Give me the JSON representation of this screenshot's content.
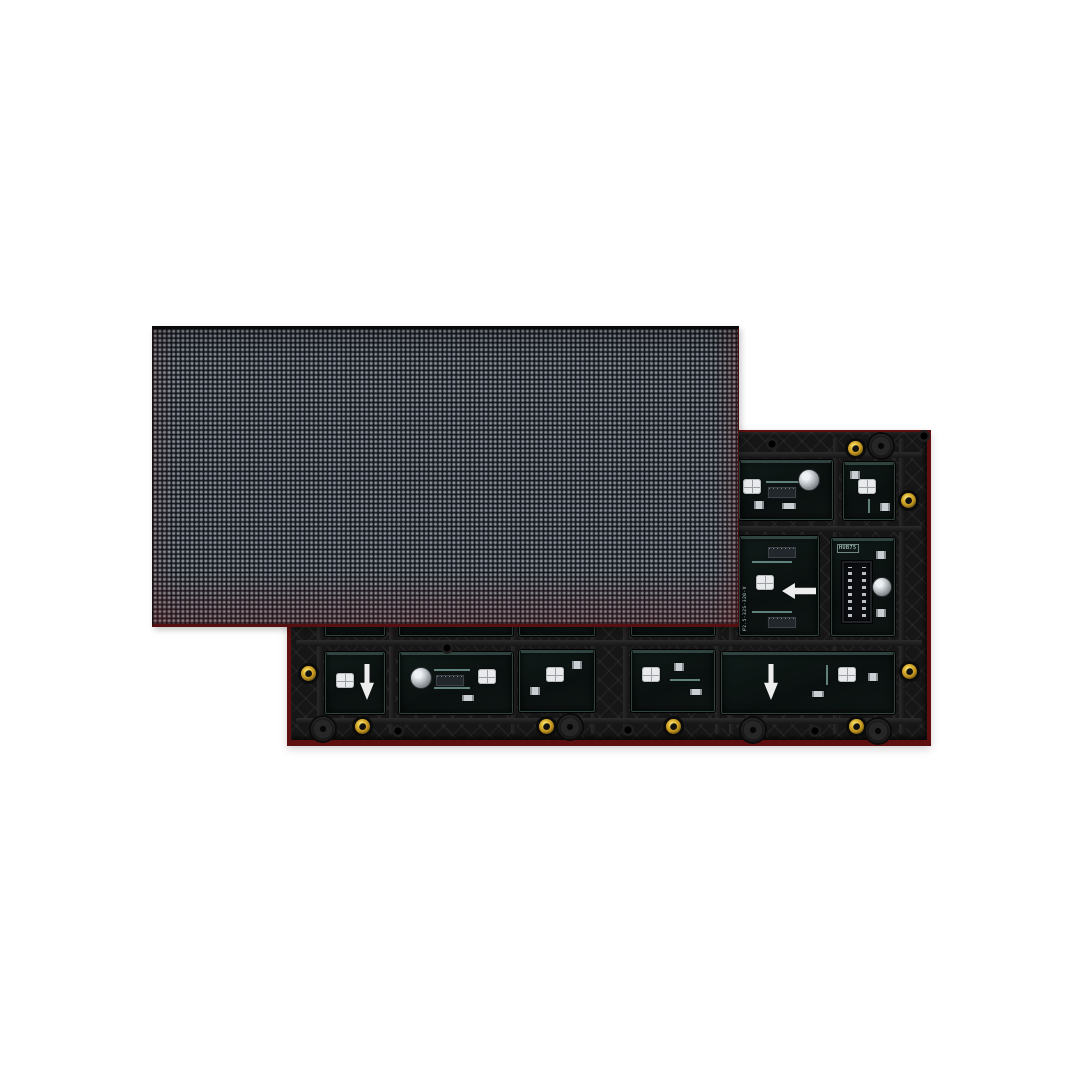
{
  "scene": {
    "background": "#ffffff"
  },
  "front_panel": {
    "kind": "led-matrix-front-face",
    "pixels_x": 128,
    "pixels_y": 64,
    "dot_pitch_px": 4.6,
    "colors": {
      "base": "#14171c",
      "dot": "#8d939b",
      "dot_ring": "#575d66",
      "pcb_edge_red": "#571010",
      "top_edge": "#0a0a0a"
    }
  },
  "back_panel": {
    "kind": "led-module-rear-pcb",
    "silkscreen_model": "P2.5-32S-320-V",
    "connector_label": "HUB75",
    "colors": {
      "frame": "#161616",
      "pcb_edge_red": "#5e1010",
      "window": "#0c1513",
      "window_border": "#30423d",
      "silkscreen": "#cfe8e2",
      "screw_brass": "#ddb331",
      "arrow": "#ededed"
    },
    "rails": {
      "h": [
        22,
        96,
        210,
        288
      ],
      "v": [
        30,
        102,
        224,
        304,
        336,
        428,
        442,
        546,
        612
      ]
    },
    "windows": [
      {
        "x": 38,
        "y": 30,
        "w": 58,
        "h": 58,
        "parts": []
      },
      {
        "x": 112,
        "y": 30,
        "w": 112,
        "h": 58,
        "parts": []
      },
      {
        "x": 232,
        "y": 30,
        "w": 74,
        "h": 58,
        "parts": []
      },
      {
        "x": 344,
        "y": 30,
        "w": 82,
        "h": 58,
        "parts": []
      },
      {
        "x": 452,
        "y": 30,
        "w": 92,
        "h": 58,
        "parts": [
          {
            "t": "led",
            "x": 3,
            "y": 18
          },
          {
            "t": "trace-h",
            "x": 26,
            "y": 20,
            "w": 34
          },
          {
            "t": "ic",
            "x": 28,
            "y": 26
          },
          {
            "t": "cap",
            "x": 58,
            "y": 8
          },
          {
            "t": "chip",
            "x": 42,
            "y": 42,
            "w": 10,
            "h": 6
          },
          {
            "t": "chip",
            "x": 14,
            "y": 40,
            "w": 6,
            "h": 8
          }
        ]
      },
      {
        "x": 556,
        "y": 32,
        "w": 50,
        "h": 56,
        "parts": [
          {
            "t": "led",
            "x": 14,
            "y": 16
          },
          {
            "t": "chip",
            "x": 6,
            "y": 8,
            "w": 6,
            "h": 8
          },
          {
            "t": "chip",
            "x": 36,
            "y": 40,
            "w": 6,
            "h": 8
          },
          {
            "t": "trace-v",
            "x": 24,
            "y": 36,
            "h": 14
          }
        ]
      },
      {
        "x": 38,
        "y": 104,
        "w": 58,
        "h": 100,
        "parts": []
      },
      {
        "x": 112,
        "y": 104,
        "w": 112,
        "h": 100,
        "parts": []
      },
      {
        "x": 232,
        "y": 104,
        "w": 74,
        "h": 100,
        "parts": []
      },
      {
        "x": 344,
        "y": 104,
        "w": 82,
        "h": 100,
        "parts": []
      },
      {
        "x": 452,
        "y": 106,
        "w": 78,
        "h": 98,
        "parts": [
          {
            "t": "trace-h",
            "x": 12,
            "y": 24,
            "w": 40
          },
          {
            "t": "ic",
            "x": 28,
            "y": 10
          },
          {
            "t": "led",
            "x": 16,
            "y": 38
          },
          {
            "t": "arrow-left",
            "x": 42,
            "y": 46
          },
          {
            "t": "vlabel",
            "x": 3,
            "y": 32,
            "h": 62,
            "bind": "silkscreen_model"
          },
          {
            "t": "ic",
            "x": 28,
            "y": 80
          },
          {
            "t": "trace-h",
            "x": 12,
            "y": 74,
            "w": 40
          }
        ]
      },
      {
        "x": 544,
        "y": 108,
        "w": 62,
        "h": 96,
        "parts": [
          {
            "t": "label",
            "x": 5,
            "y": 5,
            "bind": "connector_label"
          },
          {
            "t": "idc",
            "x": 10,
            "y": 22
          },
          {
            "t": "cap",
            "x": 40,
            "y": 38,
            "w": 18,
            "h": 18
          },
          {
            "t": "chip",
            "x": 44,
            "y": 12,
            "w": 6,
            "h": 8
          },
          {
            "t": "chip",
            "x": 44,
            "y": 70,
            "w": 6,
            "h": 8
          }
        ]
      },
      {
        "x": 38,
        "y": 222,
        "w": 58,
        "h": 60,
        "parts": [
          {
            "t": "led",
            "x": 10,
            "y": 20
          },
          {
            "t": "arrow-down",
            "x": 34,
            "y": 11
          }
        ]
      },
      {
        "x": 112,
        "y": 222,
        "w": 112,
        "h": 60,
        "parts": [
          {
            "t": "cap",
            "x": 10,
            "y": 14
          },
          {
            "t": "trace-h",
            "x": 34,
            "y": 16,
            "w": 36
          },
          {
            "t": "ic",
            "x": 36,
            "y": 22
          },
          {
            "t": "trace-h",
            "x": 34,
            "y": 34,
            "w": 36
          },
          {
            "t": "led",
            "x": 78,
            "y": 16
          },
          {
            "t": "chip",
            "x": 62,
            "y": 42,
            "w": 8,
            "h": 6
          }
        ]
      },
      {
        "x": 232,
        "y": 220,
        "w": 74,
        "h": 60,
        "parts": [
          {
            "t": "led",
            "x": 26,
            "y": 16
          },
          {
            "t": "chip",
            "x": 10,
            "y": 36,
            "w": 6,
            "h": 8
          },
          {
            "t": "chip",
            "x": 52,
            "y": 10,
            "w": 6,
            "h": 8
          }
        ]
      },
      {
        "x": 344,
        "y": 220,
        "w": 82,
        "h": 60,
        "parts": [
          {
            "t": "led",
            "x": 10,
            "y": 16
          },
          {
            "t": "chip",
            "x": 42,
            "y": 12,
            "w": 6,
            "h": 8
          },
          {
            "t": "chip",
            "x": 58,
            "y": 38,
            "w": 8,
            "h": 6
          },
          {
            "t": "trace-h",
            "x": 38,
            "y": 28,
            "w": 30
          }
        ]
      },
      {
        "x": 434,
        "y": 222,
        "w": 172,
        "h": 60,
        "parts": [
          {
            "t": "arrow-down",
            "x": 42,
            "y": 11
          },
          {
            "t": "led",
            "x": 116,
            "y": 14
          },
          {
            "t": "chip",
            "x": 90,
            "y": 38,
            "w": 8,
            "h": 6
          },
          {
            "t": "chip",
            "x": 146,
            "y": 20,
            "w": 6,
            "h": 8
          },
          {
            "t": "trace-v",
            "x": 104,
            "y": 12,
            "h": 20
          }
        ]
      }
    ],
    "screws": [
      [
        568,
        18
      ],
      [
        621,
        70
      ],
      [
        622,
        241
      ],
      [
        569,
        296
      ],
      [
        386,
        296
      ],
      [
        259,
        296
      ],
      [
        75,
        296
      ],
      [
        21,
        243
      ]
    ],
    "discs": [
      [
        594,
        16
      ],
      [
        591,
        301
      ],
      [
        466,
        300
      ],
      [
        283,
        297
      ],
      [
        36,
        299
      ]
    ],
    "holes": [
      [
        485,
        14
      ],
      [
        160,
        218
      ],
      [
        111,
        301
      ],
      [
        341,
        300
      ],
      [
        528,
        301
      ],
      [
        637,
        6
      ]
    ]
  }
}
